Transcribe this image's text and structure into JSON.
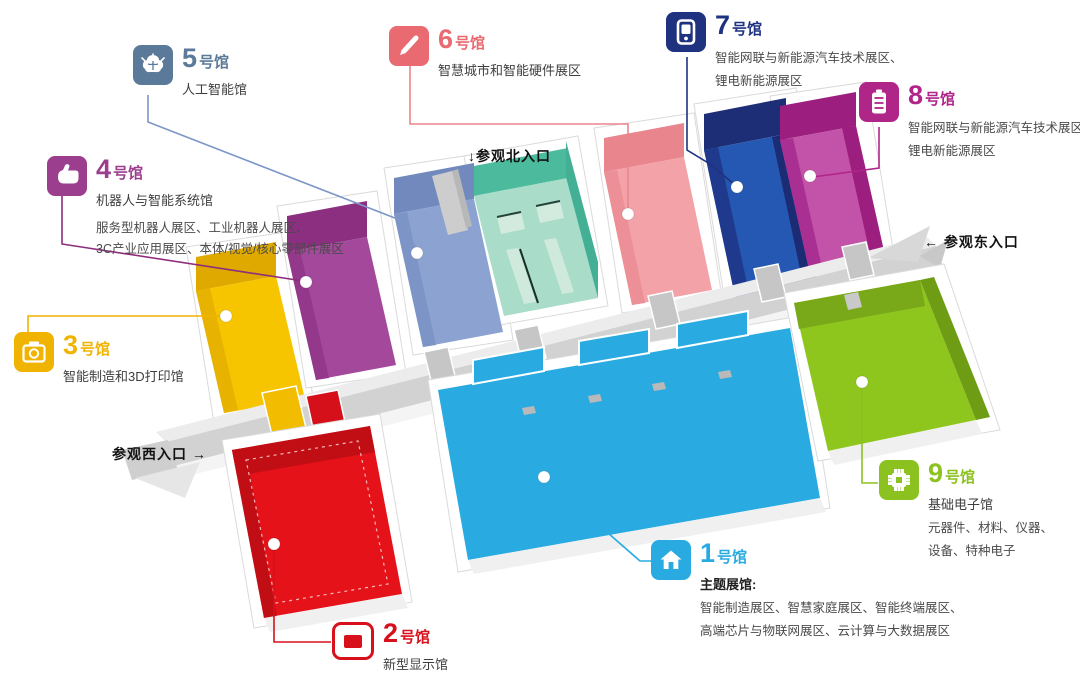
{
  "palette": {
    "hall1": "#29ABE2",
    "hall2": "#D8101C",
    "hall3": "#F0B400",
    "hall4": "#9C3E8E",
    "hall5": "#5B7A99",
    "hall6": "#E96A70",
    "hall7": "#1F3280",
    "hall8": "#B02588",
    "hall9": "#8CC21F",
    "north_hall_teal": "#4CBB9D",
    "corridor_gray": "#D2D2D2",
    "background": "#FFFFFF",
    "body_text": "#3E3E3E",
    "entrance_text": "#111111"
  },
  "halls": {
    "h1": {
      "number": "1",
      "suffix": "号馆",
      "name_bold": "主题展馆:",
      "lines": [
        "智能制造展区、智慧家庭展区、智能终端展区、",
        "高端芯片与物联网展区、云计算与大数据展区"
      ],
      "icon": "home-icon",
      "color": "#29ABE2"
    },
    "h2": {
      "number": "2",
      "suffix": "号馆",
      "name": "新型显示馆",
      "icon": "display-icon",
      "color": "#D8101C"
    },
    "h3": {
      "number": "3",
      "suffix": "号馆",
      "name": "智能制造和3D打印馆",
      "icon": "printer-icon",
      "color": "#F0B400"
    },
    "h4": {
      "number": "4",
      "suffix": "号馆",
      "name": "机器人与智能系统馆",
      "lines": [
        "服务型机器人展区、工业机器人展区、",
        "3C产业应用展区、本体/视觉/核心零部件展区"
      ],
      "icon": "hand-icon",
      "color": "#9C3E8E"
    },
    "h5": {
      "number": "5",
      "suffix": "号馆",
      "name": "人工智能馆",
      "icon": "brain-icon",
      "color": "#5B7A99"
    },
    "h6": {
      "number": "6",
      "suffix": "号馆",
      "name": "智慧城市和智能硬件展区",
      "icon": "pen-icon",
      "color": "#E96A70"
    },
    "h7": {
      "number": "7",
      "suffix": "号馆",
      "lines": [
        "智能网联与新能源汽车技术展区、",
        "锂电新能源展区"
      ],
      "icon": "charging-device-icon",
      "color": "#1F3280"
    },
    "h8": {
      "number": "8",
      "suffix": "号馆",
      "lines": [
        "智能网联与新能源汽车技术展区",
        "锂电新能源展区"
      ],
      "icon": "battery-icon",
      "color": "#B02588"
    },
    "h9": {
      "number": "9",
      "suffix": "号馆",
      "name": "基础电子馆",
      "lines": [
        "元器件、材料、仪器、",
        "设备、特种电子"
      ],
      "icon": "chip-icon",
      "color": "#8CC21F"
    }
  },
  "entrances": {
    "north": {
      "arrow": "↓",
      "text": "参观北入口"
    },
    "east": {
      "arrow": "←",
      "text": "参观东入口"
    },
    "west": {
      "text": "参观西入口",
      "arrow": "→"
    }
  }
}
